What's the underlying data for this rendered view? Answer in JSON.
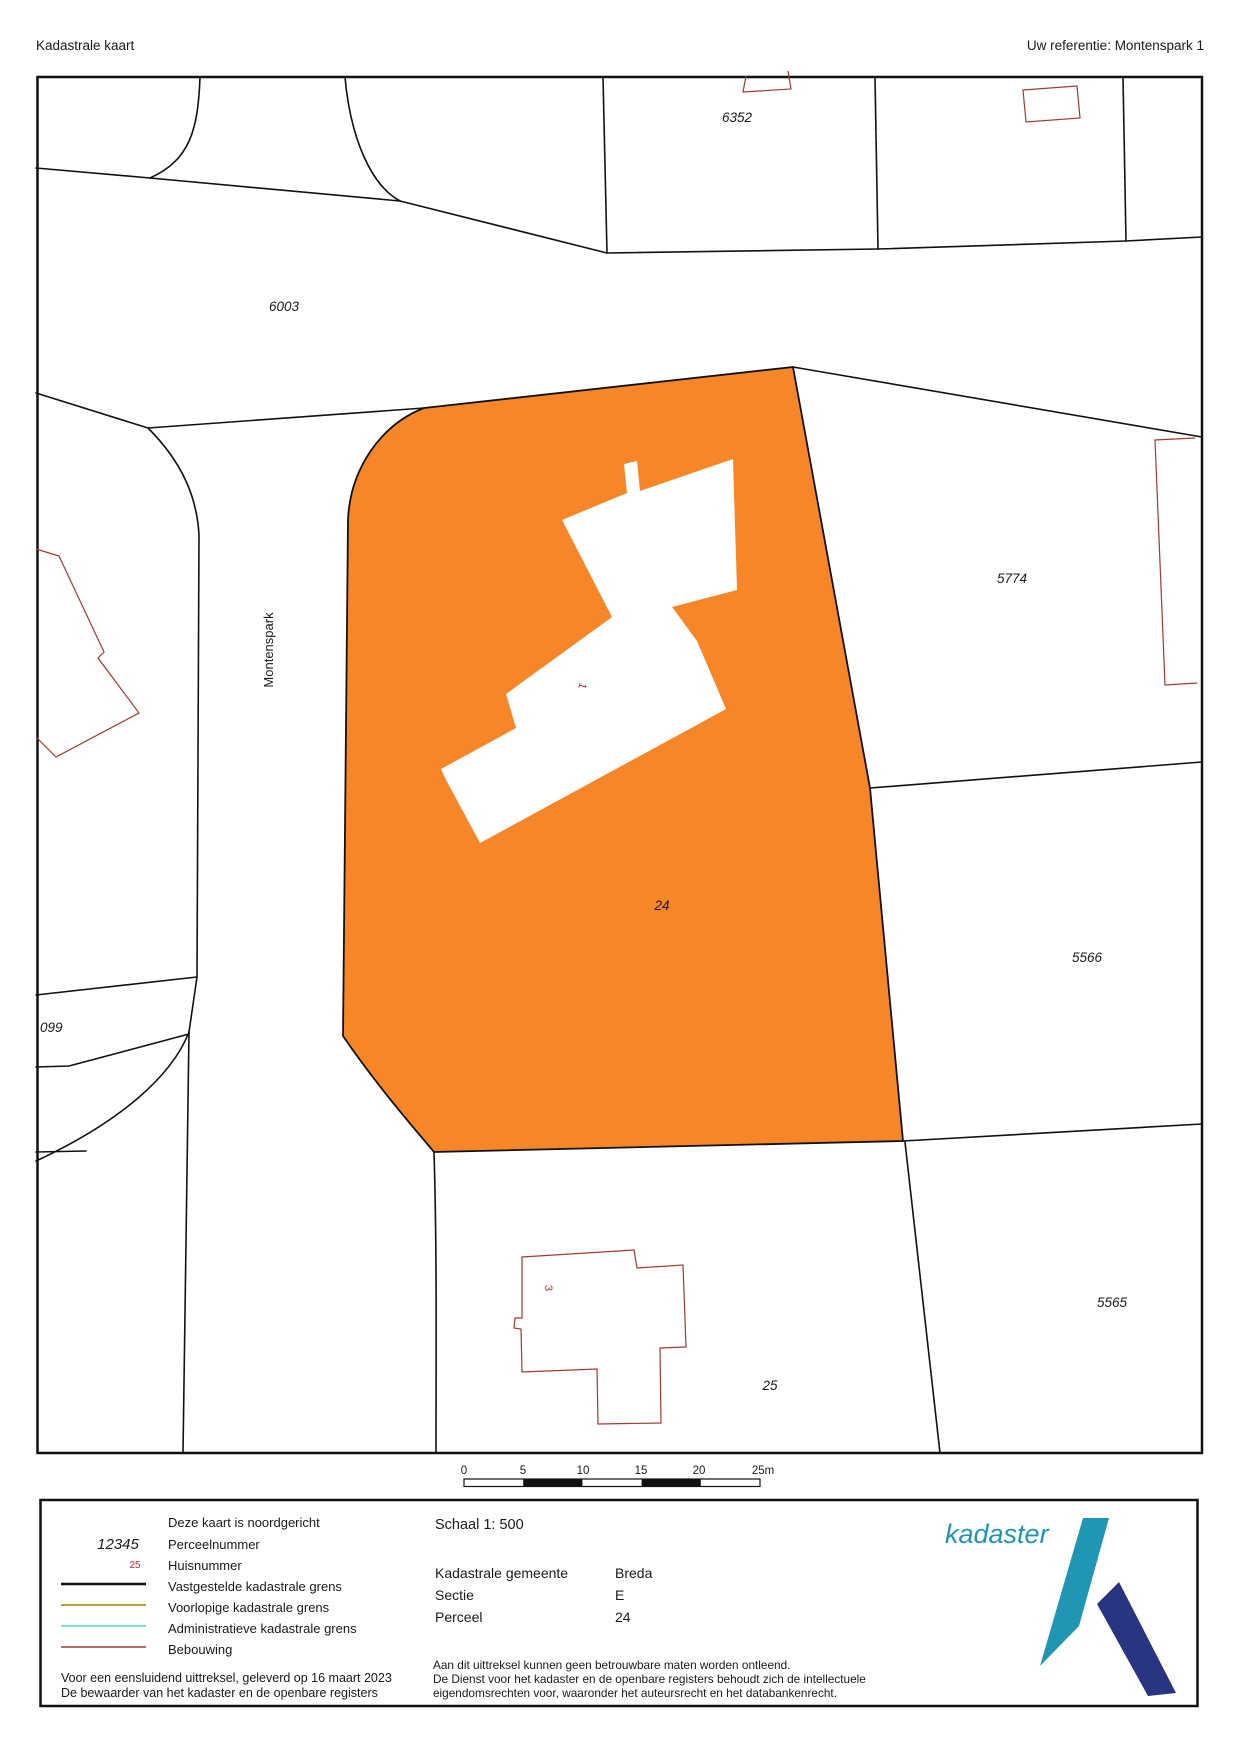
{
  "header": {
    "title": "Kadastrale kaart",
    "reference": "Uw referentie: Montenspark 1"
  },
  "map": {
    "parcel_labels": [
      {
        "text": "6352"
      },
      {
        "text": "6003"
      },
      {
        "text": "5774"
      },
      {
        "text": "5566"
      },
      {
        "text": "5565"
      },
      {
        "text": "25"
      },
      {
        "text": "24"
      },
      {
        "text": "099"
      }
    ],
    "street_label": "Montenspark",
    "house_numbers": [
      {
        "text": "1"
      },
      {
        "text": "3"
      }
    ],
    "highlight_color": "#F68628",
    "boundary_color": "#111111",
    "building_outline_color": "#9E3B33",
    "house_number_color": "#C2272D",
    "scale_bar": {
      "labels": [
        "0",
        "5",
        "10",
        "15",
        "20",
        "25m"
      ]
    }
  },
  "legend": {
    "north_note": "Deze kaart is noordgericht",
    "items": [
      {
        "symbol": "12345",
        "label": "Perceelnummer"
      },
      {
        "symbol": "25",
        "label": "Huisnummer"
      },
      {
        "label": "Vastgestelde kadastrale grens",
        "color": "#111111"
      },
      {
        "label": "Voorlopige kadastrale grens",
        "color": "#BFA030"
      },
      {
        "label": "Administratieve kadastrale grens",
        "color": "#7FE3D4"
      },
      {
        "label": "Bebouwing",
        "color": "#9E3B33"
      }
    ],
    "footer_line1": "Voor een eensluidend uittreksel, geleverd op 16 maart 2023",
    "footer_line2": "De bewaarder van het kadaster en de openbare registers",
    "scale_text": "Schaal 1: 500",
    "details": [
      {
        "label": "Kadastrale gemeente",
        "value": "Breda"
      },
      {
        "label": "Sectie",
        "value": "E"
      },
      {
        "label": "Perceel",
        "value": "24"
      }
    ],
    "disclaimer_line1": "Aan dit uittreksel kunnen geen betrouwbare maten worden ontleend.",
    "disclaimer_line2": "De Dienst voor het kadaster en de openbare registers behoudt zich de intellectuele",
    "disclaimer_line3": "eigendomsrechten voor, waaronder het auteursrecht en het databankenrecht.",
    "logo_text": "kadaster",
    "logo_teal": "#2196B4",
    "logo_navy": "#2A3582"
  }
}
